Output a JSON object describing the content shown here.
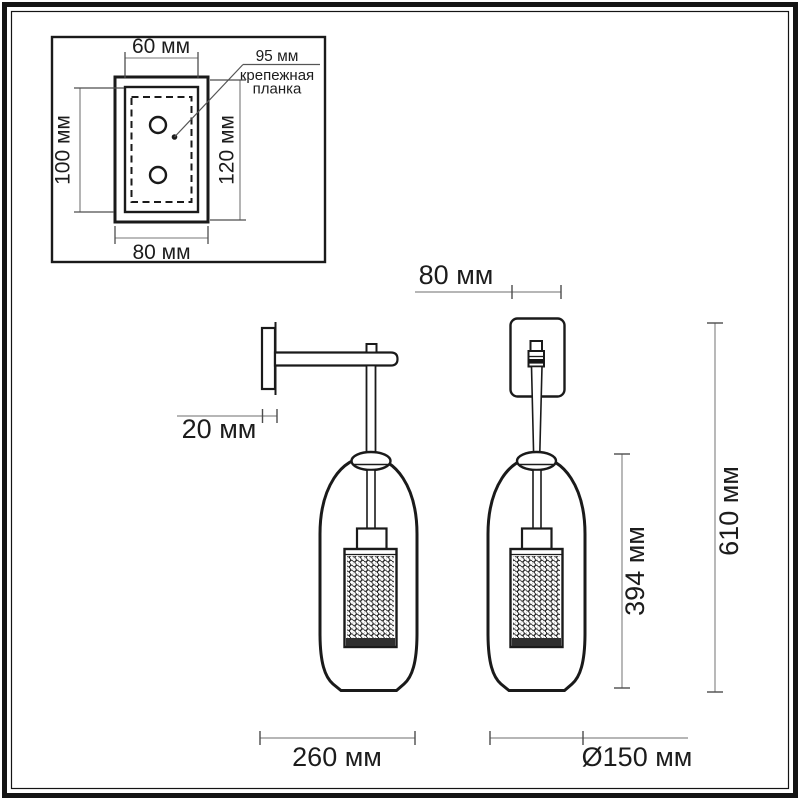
{
  "title": "Wall sconce dimension drawing",
  "colors": {
    "background": "#ffffff",
    "frame": "#141414",
    "outline": "#1a1a1a",
    "dim_line": "#8a8a8a",
    "tick": "#4d4d4d",
    "text": "#1c1c1c"
  },
  "inset": {
    "width_top": "60 мм",
    "holes_distance": "95 мм",
    "callout_line1": "крепежная",
    "callout_line2": "планка",
    "height_inner": "100 мм",
    "height_outer": "120 мм",
    "width_bottom": "80 мм"
  },
  "dimensions": {
    "backplate_width": "80 мм",
    "backplate_depth": "20 мм",
    "shade_height": "394 мм",
    "overall_height": "610 мм",
    "projection": "260 мм",
    "shade_diameter": "Ø150 мм"
  }
}
